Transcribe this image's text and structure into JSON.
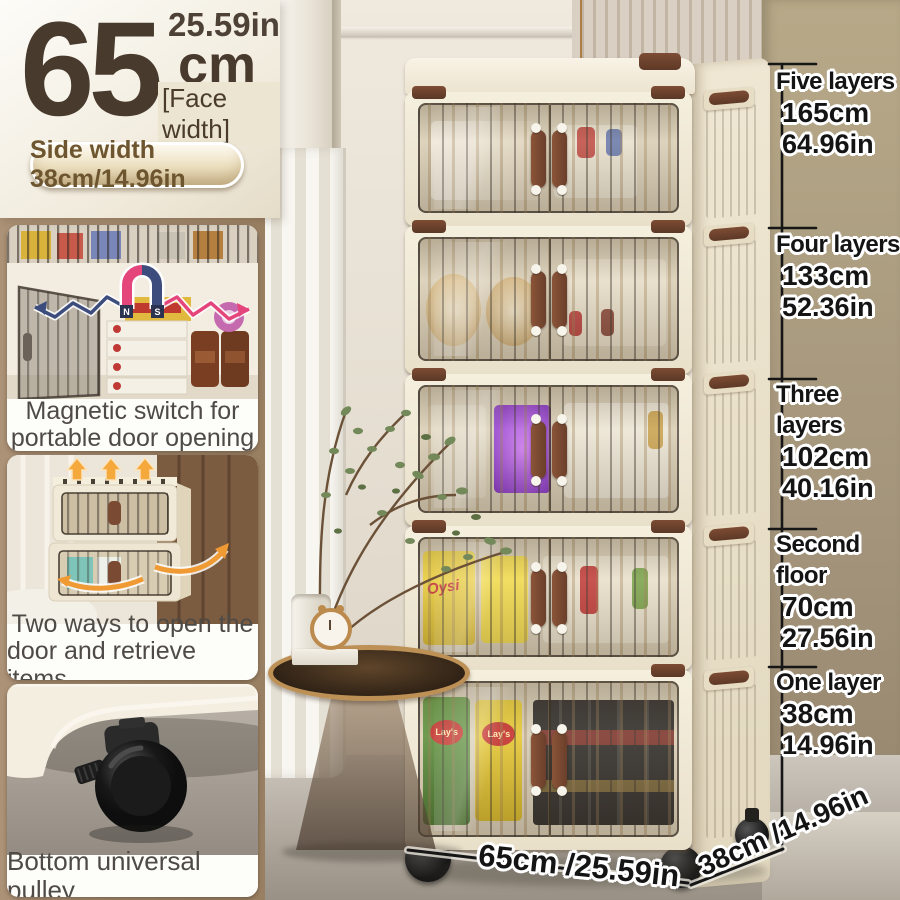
{
  "header": {
    "inches": "25.59in",
    "value": "65",
    "unit": "cm",
    "face_label": "[Face width]",
    "side_width": "Side width 38cm/14.96in"
  },
  "features": [
    {
      "line1": "Magnetic switch for",
      "line2": "portable door opening",
      "magnet_n": "N",
      "magnet_s": "S"
    },
    {
      "line1": "Two ways to open the",
      "line2": "door and retrieve items"
    },
    {
      "line1": "Bottom universal pulley"
    }
  ],
  "heights": [
    {
      "label": "Five layers",
      "cm": "165cm",
      "inch": "64.96in"
    },
    {
      "label": "Four layers",
      "cm": "133cm",
      "inch": "52.36in"
    },
    {
      "label": "Three layers",
      "cm": "102cm",
      "inch": "40.16in"
    },
    {
      "label": "Second floor",
      "cm": "70cm",
      "inch": "27.56in"
    },
    {
      "label": "One layer",
      "cm": "38cm",
      "inch": "14.96in"
    }
  ],
  "footprint": {
    "width": "65cm /25.59in",
    "depth": "38cm /14.96in"
  },
  "products": {
    "bag_brand": "Oysi",
    "chips_brand": "Lay's"
  },
  "colors": {
    "sidebar_brown": "#a38a6d",
    "cabinet_cream": "#f1ead9",
    "handle_brown": "#7a4a32",
    "wall_tan": "#a79878",
    "accent_orange": "#f09a34",
    "magnet_pink": "#e4457a",
    "magnet_navy": "#3c4c7c",
    "dimension_line": "#161616"
  }
}
